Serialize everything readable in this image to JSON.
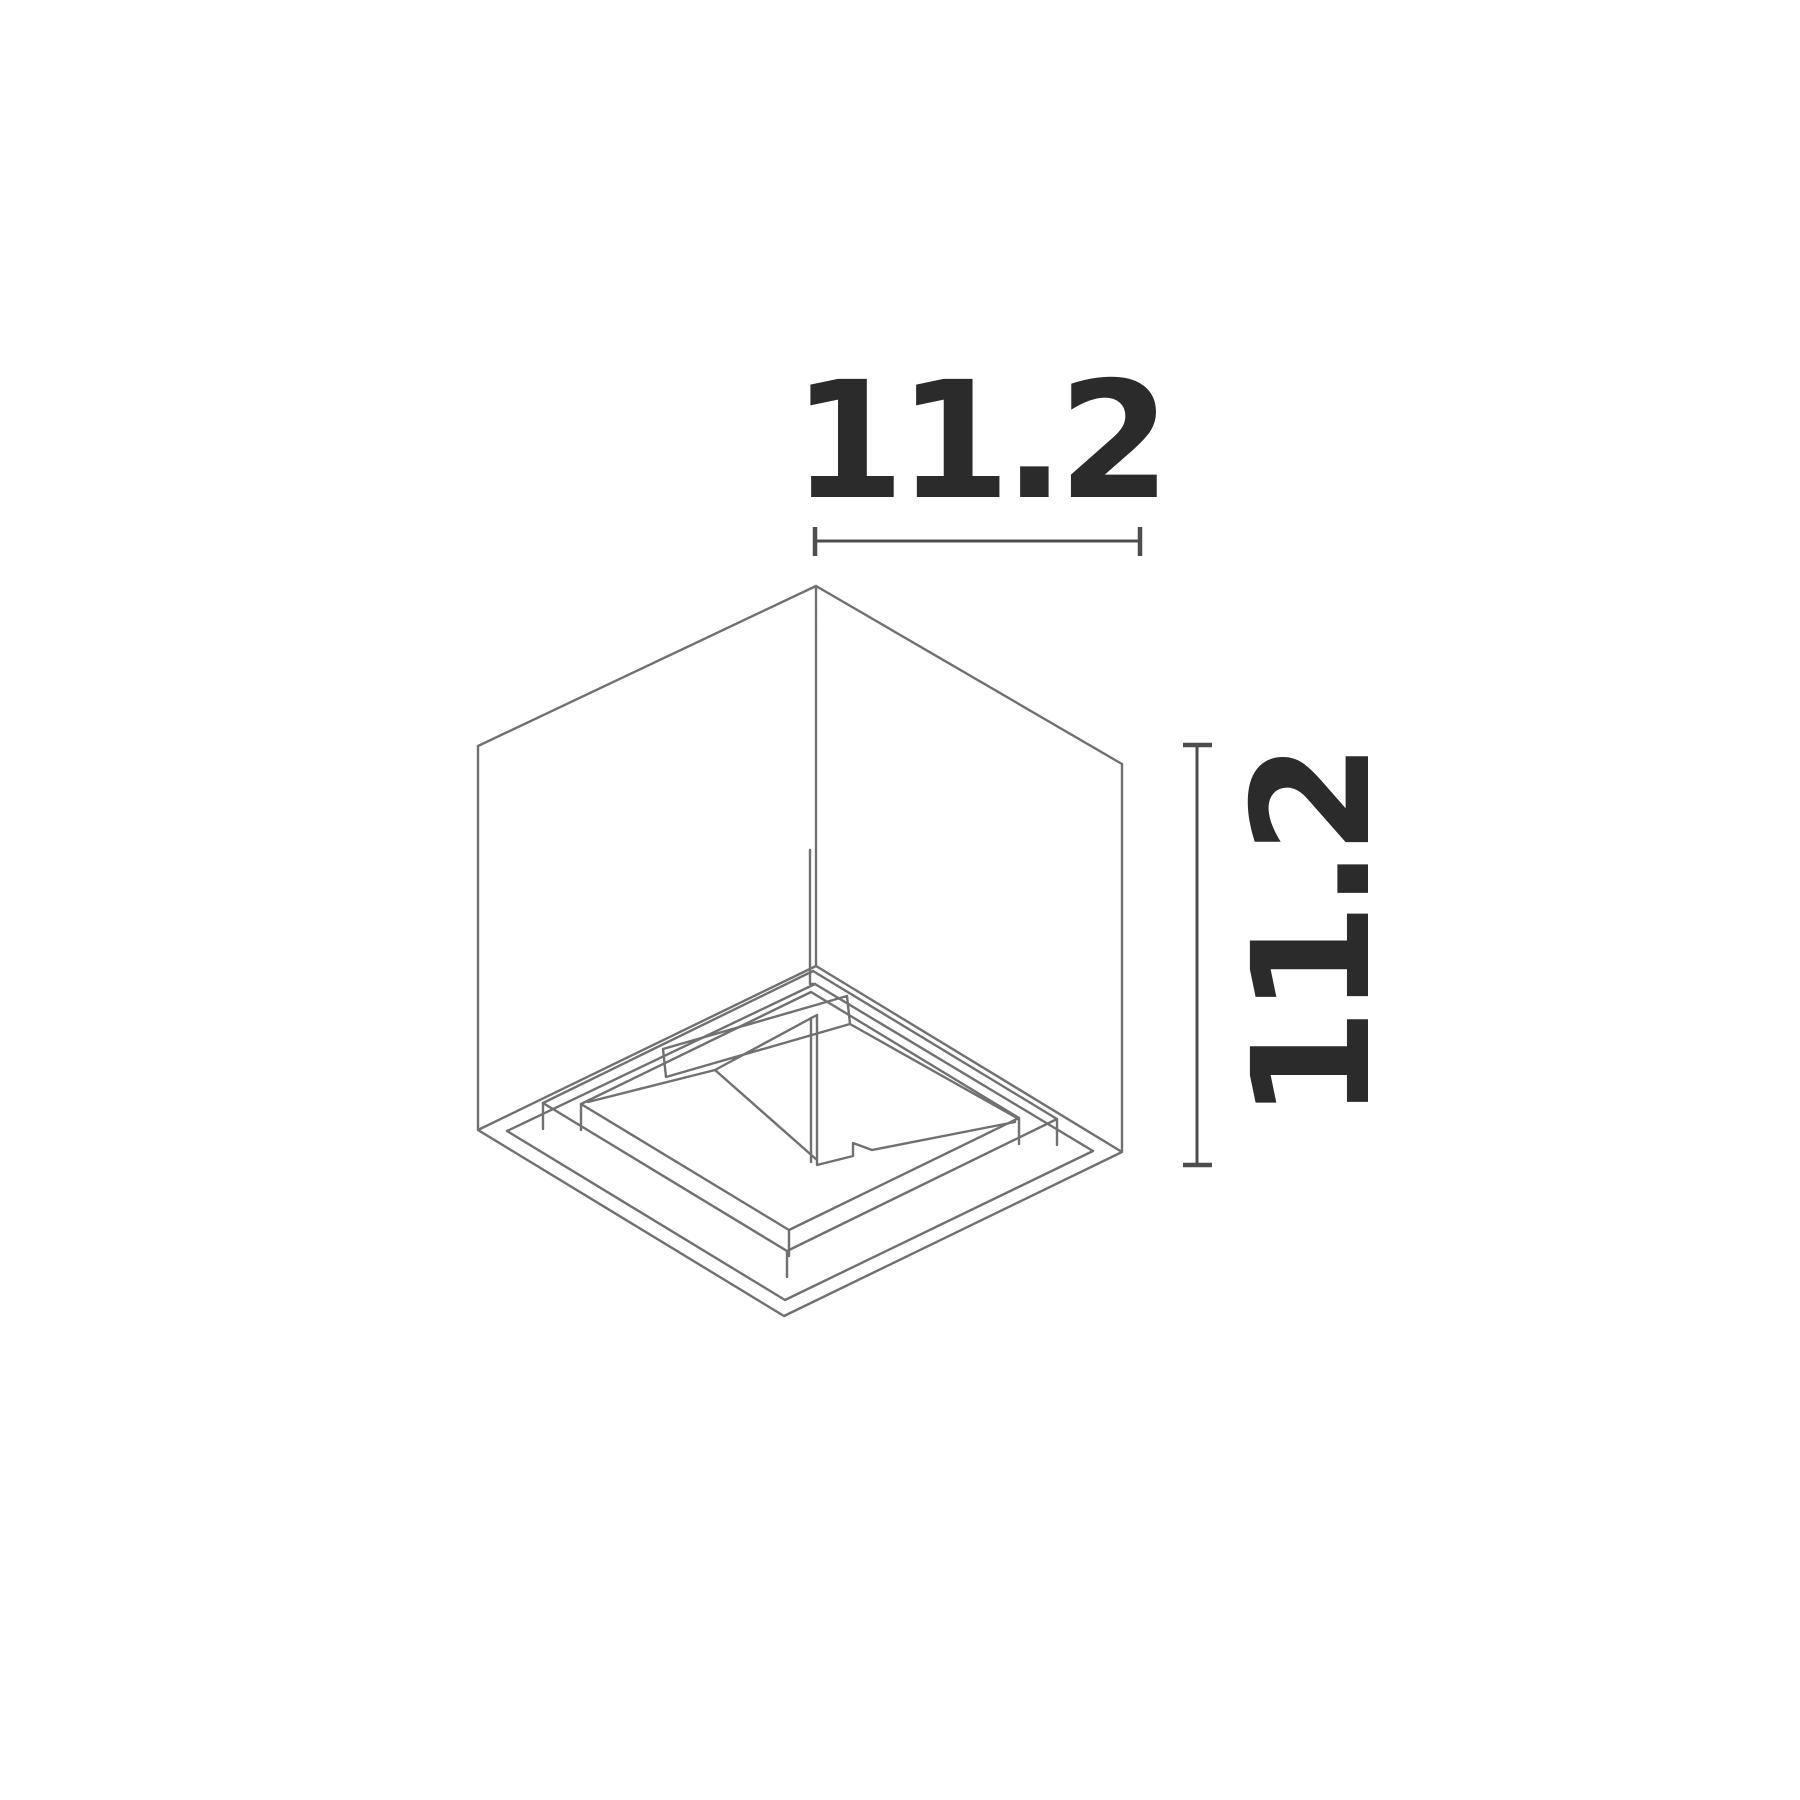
{
  "figure": {
    "kind": "isometric-dimension-drawing",
    "dimensions": {
      "width_label": "11.2",
      "height_label": "11.2"
    },
    "colors": {
      "background": "#ffffff",
      "line": "#707070",
      "dimension": "#4d4d4d",
      "text": "#2b2b2b"
    }
  }
}
